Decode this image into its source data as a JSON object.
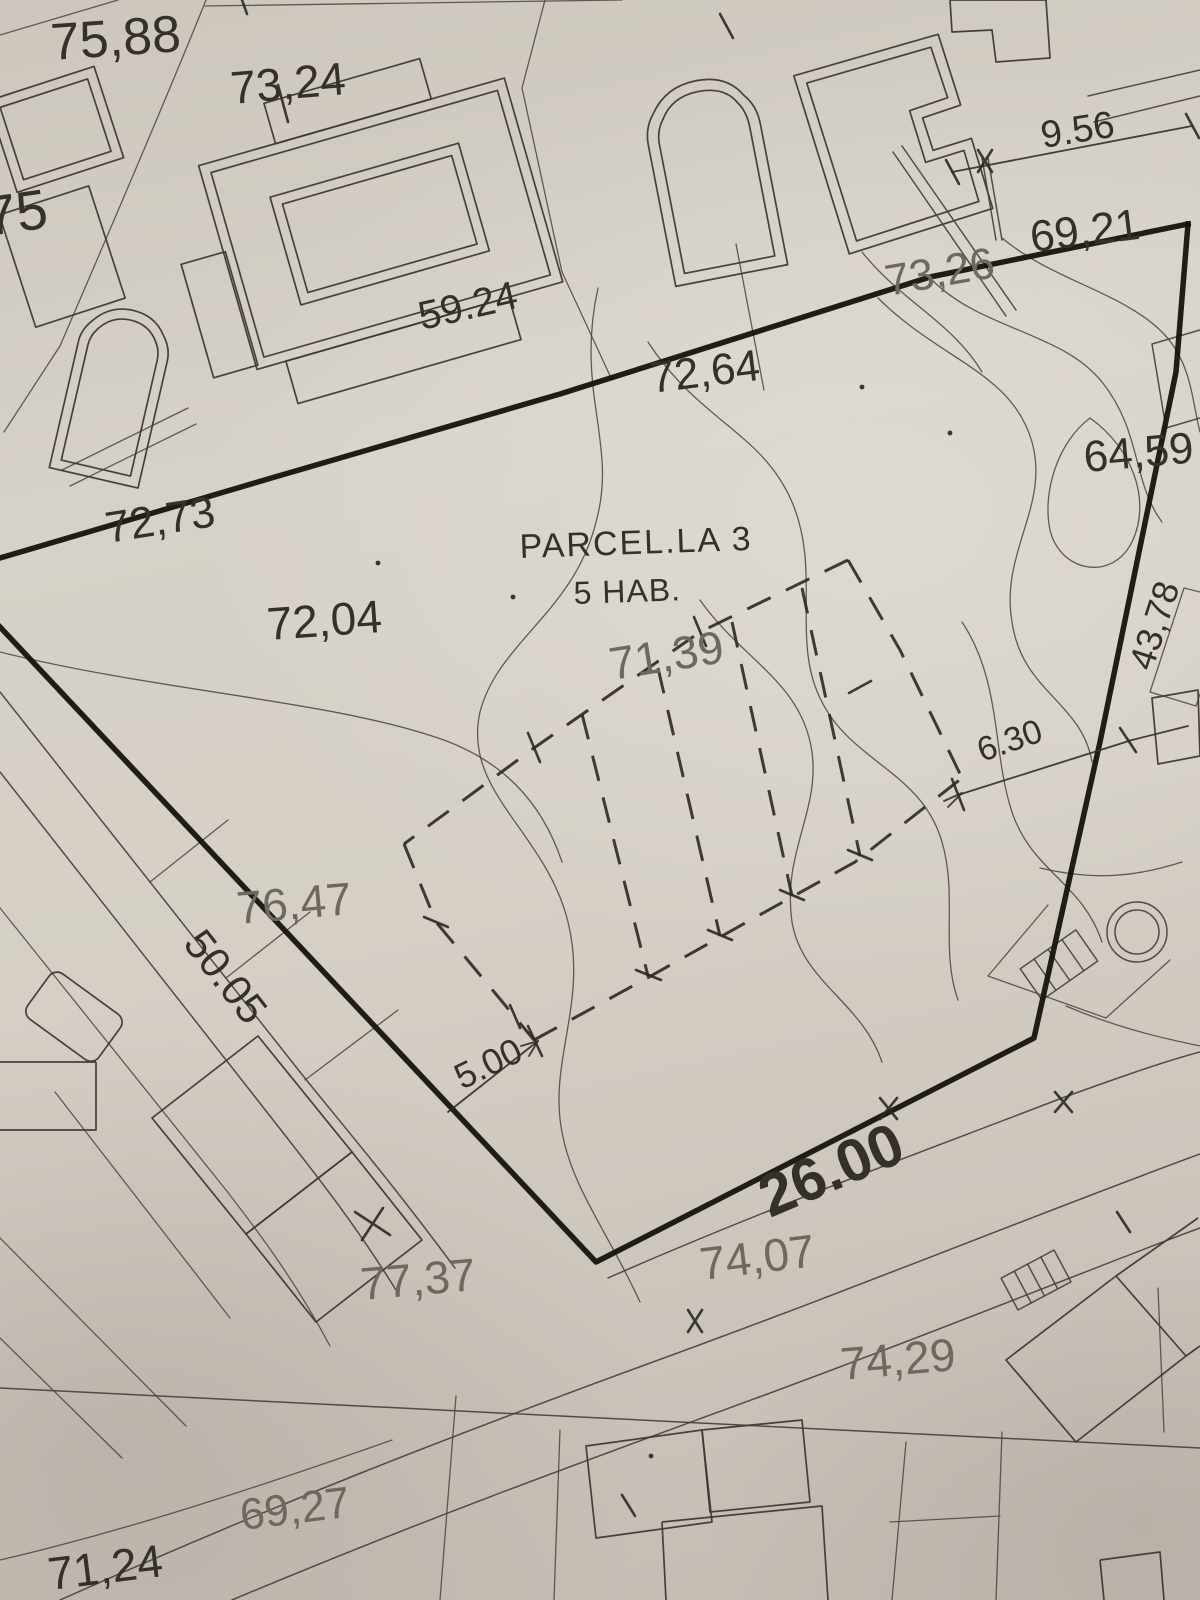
{
  "map": {
    "parcel": {
      "title": "PARCEL.LA 3",
      "subtitle": "5 HAB."
    },
    "spot_elevations": {
      "top_left_1": "75,88",
      "top_left_2": "73,24",
      "left_edge": "75",
      "top_right_1": "69,21",
      "top_right_2": "73,26",
      "upper_mid": "72,64",
      "right_edge_mid": "64,59",
      "left_mid": "72,73",
      "center_left": "72,04",
      "center": "71,39",
      "lower_left": "76,47",
      "bottom_center": "74,07",
      "bottom_left": "77,37",
      "bottom_right": "74,29",
      "bottom_strip_left": "69,27",
      "bottom_strip_far_left": "71,24"
    },
    "dimensions": {
      "top_right": "9.56",
      "building_length": "59.24",
      "right_edge_side": "43,78",
      "setback_right": "6.30",
      "setback_left": "5.00",
      "frontage": "26.00",
      "side_left": "50.05"
    },
    "colors": {
      "paper": "#d2ccc3",
      "ink": "#35302a",
      "ink_faint": "#6f685f",
      "boundary_ink": "#16130e"
    }
  }
}
